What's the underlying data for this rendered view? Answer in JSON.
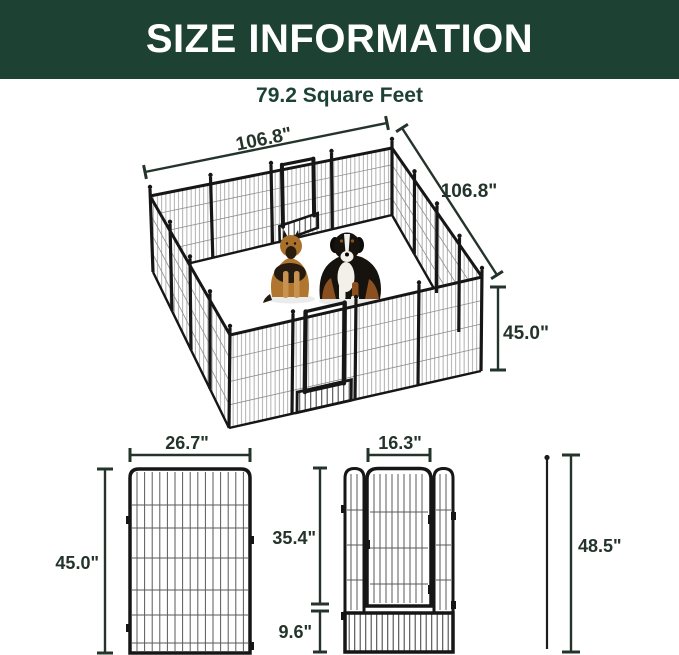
{
  "header": {
    "title": "SIZE INFORMATION",
    "subtitle": "79.2 Square Feet"
  },
  "playpen_view": {
    "top_width_label": "106.8\"",
    "side_depth_label": "106.8\"",
    "height_label": "45.0\"",
    "contents": [
      "german-shepherd-dog",
      "bernese-mountain-dog"
    ],
    "doors_visible": 2
  },
  "panel_diagram": {
    "width_label": "26.7\"",
    "height_label": "45.0\""
  },
  "door_panel_diagram": {
    "door_width_label": "16.3\"",
    "door_height_label": "35.4\"",
    "bottom_section_label": "9.6\""
  },
  "stake_diagram": {
    "height_label": "48.5\""
  },
  "colors": {
    "header_bg": "#1d4132",
    "header_text": "#ffffff",
    "subtitle_text": "#1d4132",
    "dimension_lines": "#24342b",
    "panel_frame": "#161616",
    "mesh_wire": "#8e8e8e"
  }
}
